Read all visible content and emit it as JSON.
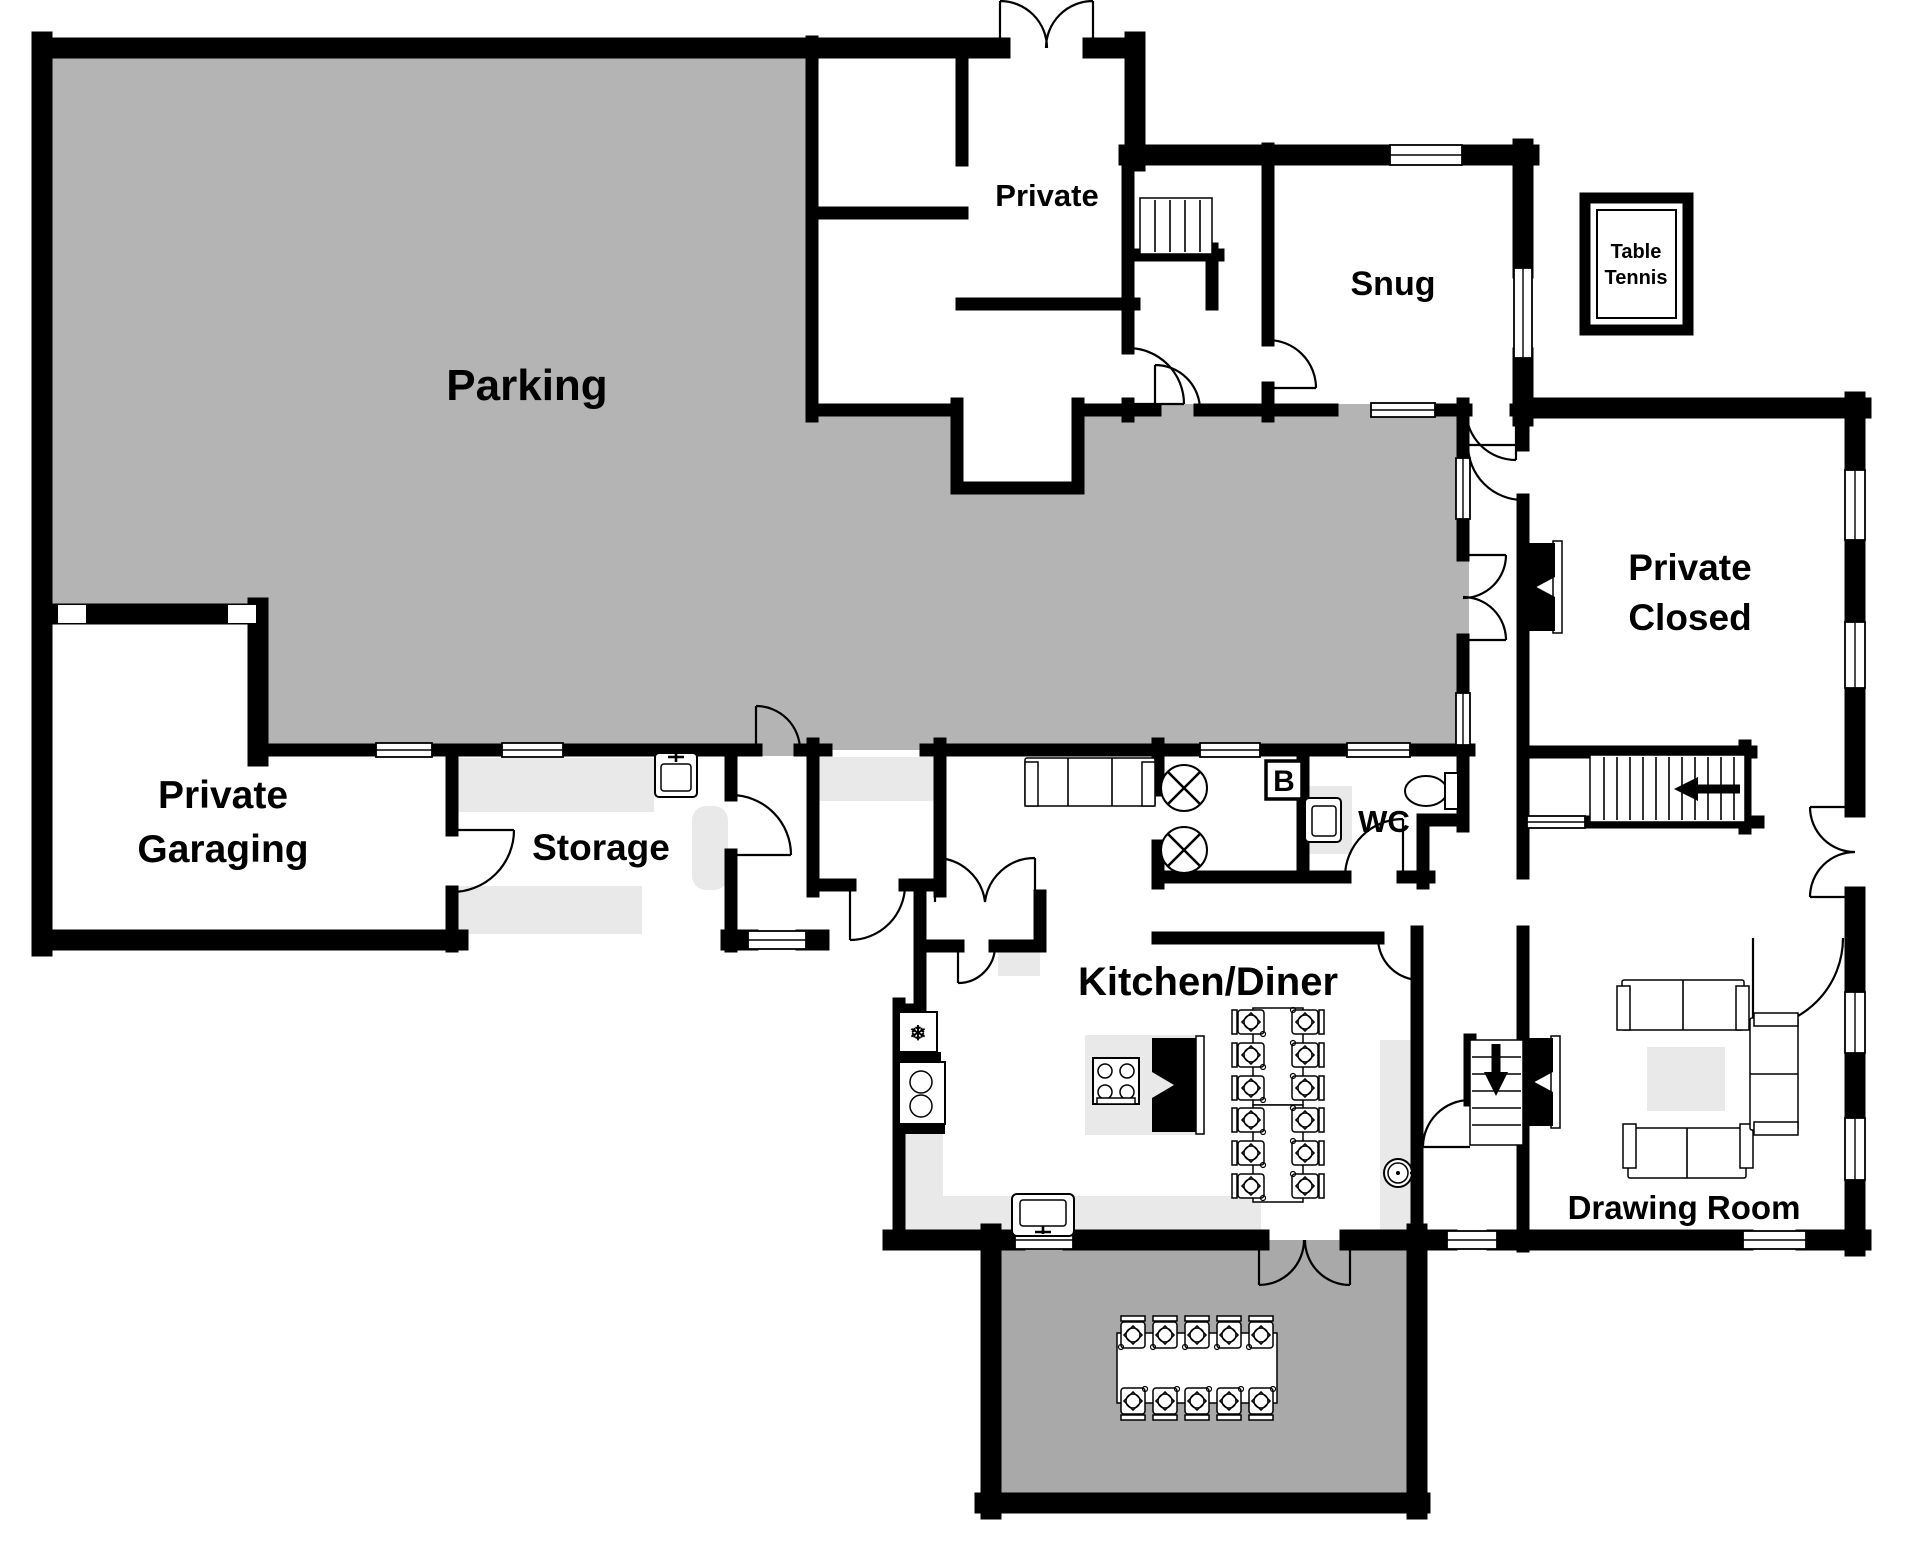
{
  "labels": {
    "parking": "Parking",
    "private_room": "Private",
    "snug": "Snug",
    "table_tennis_1": "Table",
    "table_tennis_2": "Tennis",
    "private_closed_1": "Private",
    "private_closed_2": "Closed",
    "garaging_1": "Private",
    "garaging_2": "Garaging",
    "storage": "Storage",
    "wc": "WC",
    "boiler": "B",
    "kitchen_diner": "Kitchen/Diner",
    "drawing_room": "Drawing Room"
  },
  "fixtures": {
    "fridge_icon": "❄"
  },
  "colors": {
    "wall": "#000000",
    "parking_fill": "#b4b4b4",
    "patio_fill": "#a9a9a9",
    "counter_fill": "#e9e9e9",
    "label_color": "#000000"
  }
}
